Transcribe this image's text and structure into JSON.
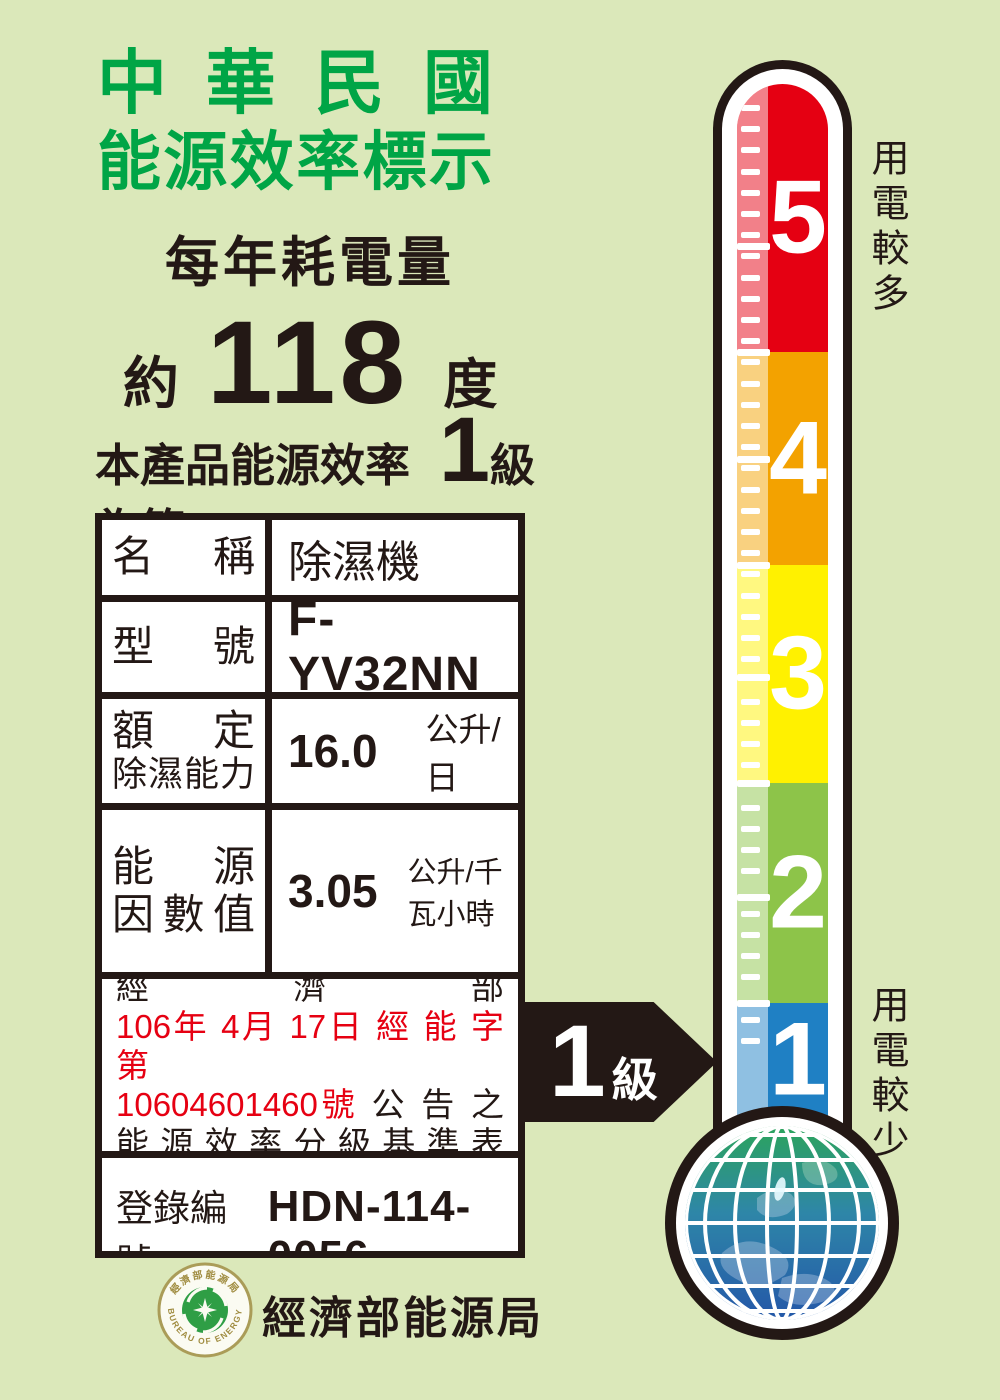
{
  "page": {
    "background": "#DBE8BA"
  },
  "header": {
    "title_line1": "中 華 民 國",
    "title_line2": "能源效率標示",
    "title_color": "#00A546",
    "subtitle": "每年耗電量",
    "approx": "約",
    "annual_consumption": "118",
    "unit": "度",
    "grade_prefix": "本產品能源效率為第",
    "grade": "1",
    "grade_suffix": "級"
  },
  "table": {
    "name_label": "名 稱",
    "name_value": "除濕機",
    "model_label": "型 號",
    "model_value": "F-YV32NN",
    "capacity_label_line1": "額 定",
    "capacity_label_line2": "除濕能力",
    "capacity_value": "16.0",
    "capacity_unit": "公升/日",
    "factor_label_line1": "能 源",
    "factor_label_line2": "因數值",
    "factor_value": "3.05",
    "factor_unit": "公升/千瓦小時",
    "notice_lines": [
      [
        {
          "text": "本產品能源效率分級係依經濟部",
          "red": false
        }
      ],
      [
        {
          "text": "106年 4月 17日 經 能 字 第",
          "red": true
        }
      ],
      [
        {
          "text": "10604601460號",
          "red": true
        },
        {
          "text": " 公 告 之",
          "red": false
        }
      ],
      [
        {
          "text": "能 源 效 率 分 級 基 準 表 標 示",
          "red": false
        }
      ]
    ],
    "red_color": "#E60012",
    "registration_label": "登錄編號：",
    "registration_value": "HDN-114-0056"
  },
  "thermometer": {
    "top_label": "用電較多",
    "bottom_label": "用電較少",
    "levels": [
      {
        "num": "5",
        "color": "#E50012",
        "height": 268
      },
      {
        "num": "4",
        "color": "#F3A200",
        "height": 213
      },
      {
        "num": "3",
        "color": "#FFF100",
        "height": 218
      },
      {
        "num": "2",
        "color": "#8DC449",
        "height": 220
      },
      {
        "num": "1",
        "color": "#1F80C4",
        "height": 157
      }
    ],
    "arrow_grade": "1",
    "arrow_suffix": "級"
  },
  "footer": {
    "agency": "經濟部能源局",
    "seal_top": "經濟部能源局",
    "seal_bottom": "BUREAU OF ENERGY"
  }
}
